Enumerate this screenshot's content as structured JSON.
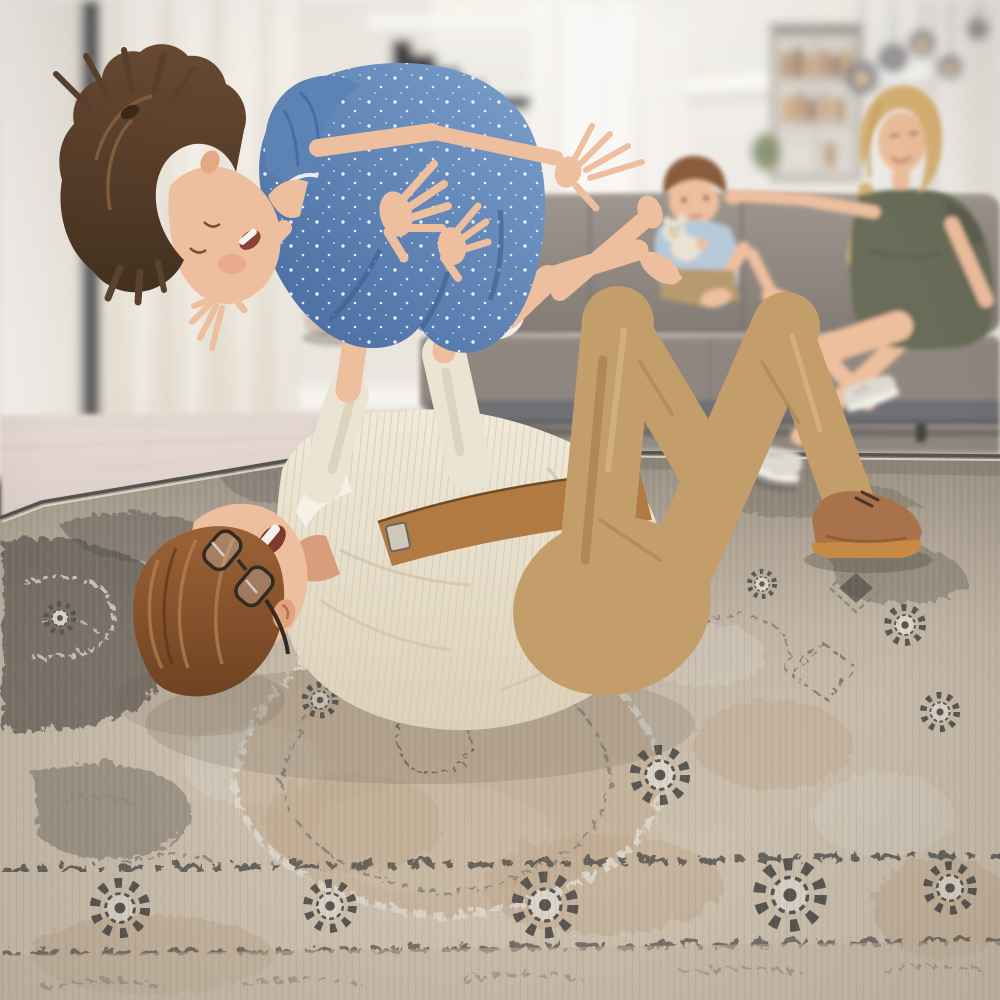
{
  "scene": {
    "alt": "A laughing father lies on a large distressed vintage beige-and-grey area rug lifting his daughter overhead airplane-style, while the mother and a toddler hugging a teddy bear watch from a grey sofa in a bright modern living room.",
    "setting": "bright modern open-plan living room with sheer curtains, dark staircase, glass drinks cabinet and smoked-glass pendant lights",
    "subjects": [
      {
        "name": "father",
        "pose": "lying on his back on the rug, knees bent, arms raised lifting daughter",
        "clothing": "cream striped shirt, khaki chinos, brown leather belt, brown suede boots, glasses"
      },
      {
        "name": "daughter",
        "pose": "held aloft, arms spread wide, ponytail hanging, laughing",
        "clothing": "blue dress with small white floral print"
      },
      {
        "name": "mother",
        "pose": "seated on sofa, legs crossed, smiling at the family",
        "clothing": "olive green dress, white sneakers, blonde hair"
      },
      {
        "name": "toddler",
        "pose": "sitting on sofa hugging a cream teddy bear, barefoot",
        "clothing": "light blue t-shirt, beige shorts"
      }
    ],
    "furnishings": [
      "grey fabric sofa",
      "beige cylindrical pouf",
      "round wicker basket",
      "sheer white curtains",
      "dark staircase silhouette",
      "glass drinks cabinet with amber bottles",
      "smoked-glass pendant lights",
      "recessed ceiling spotlights",
      "pale tile floor"
    ],
    "product": {
      "name": "distressed vintage oriental medallion area rug",
      "colors": "beige, taupe, ivory, charcoal grey",
      "features": [
        "central scalloped medallion",
        "floral rosettes",
        "double guard-stripe border",
        "worn low-pile texture"
      ]
    },
    "camera": {
      "focus": "rug and foreground family sharp",
      "background": "soft depth-of-field blur"
    }
  },
  "palette": {
    "wall": "#ece7e1",
    "cove": "#fbfaf7",
    "window_frame": "#46464a",
    "curtain": "#f1ece4",
    "stair": "#2e2f33",
    "door_glass": "#f7f5f1",
    "pillar": "#f2efea",
    "floor_pink": "#ead9d3",
    "cabinet_frame": "#b5aea3",
    "cabinet_glass": "#dcd8d1",
    "bottle_amber": "#b8813f",
    "bottle_dark": "#8a5c28",
    "bottle_gold": "#c99a55",
    "plant": "#7c8a64",
    "pendant_glow": "#f5bc66",
    "couch": "#948c85",
    "couch_dark": "#7b736c",
    "couch_base": "#707175",
    "pouf": "#cabdab",
    "basket": "#b8996e",
    "skin": "#eebf9e",
    "skin_shadow": "#d89d7a",
    "blush": "#dd8f70",
    "girl_hair": "#5a4130",
    "girl_hair_light": "#8a6544",
    "dress_blue": "#5d83b5",
    "dress_blue_dark": "#41639a",
    "dress_dot": "#e9eef5",
    "mom_hair": "#d8b275",
    "mom_dress": "#686c58",
    "sneaker": "#dedad2",
    "sneaker_sole": "#f0eee8",
    "toddler_hair": "#8a5c3c",
    "toddler_shirt": "#b6c9da",
    "toddler_shorts": "#b79a6e",
    "teddy": "#eae3d3",
    "dad_hair": "#8a5531",
    "dad_hair_light": "#c08a52",
    "shirt_cream": "#ece4d3",
    "shirt_stripe": "#d2c5ab",
    "pants_khaki": "#c49e6a",
    "pants_shadow": "#9a7946",
    "pants_light": "#dcbe85",
    "belt": "#b07a42",
    "boot": "#a8734a",
    "boot_sole": "#c78a45",
    "glasses": "#332a22",
    "teeth": "#f6f2ea",
    "rug_tan": "#c5ab8d",
    "rug_cream": "#e6e0d4",
    "rug_charcoal": "#4e4a45",
    "rug_gray": "#8b867e",
    "rug_edge": "#57534d"
  }
}
